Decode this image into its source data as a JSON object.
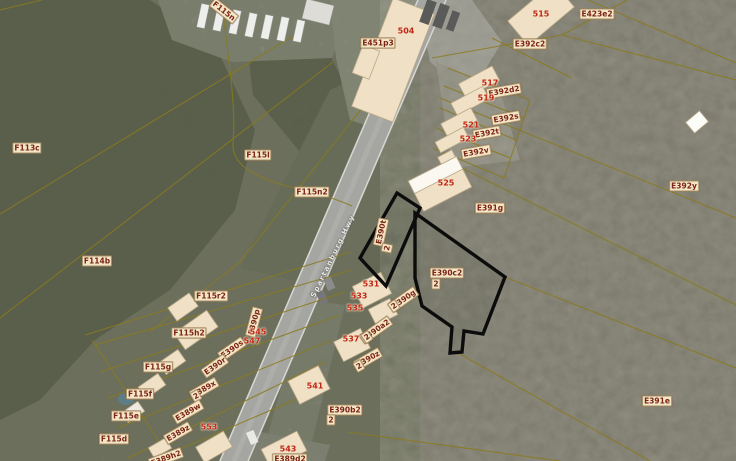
{
  "map": {
    "title": "aerial-parcel-map",
    "road_label": "Spartanburg Hwy",
    "selected_parcel": {
      "id": "E390c2",
      "sub": "2"
    },
    "colors": {
      "highlight_outline": "#0c0c0c",
      "parcel_line": "#8a7a1e",
      "parcel_label_text": "#7c2315",
      "parcel_label_bg": "#f2e6c6",
      "house_number_text": "#c22517",
      "building_fill": "#efe0c6",
      "woods": "#51554a",
      "field": "#79766a",
      "road": "#a5a5a1"
    },
    "parcel_labels": [
      {
        "text": "F115n",
        "x": 224,
        "y": 11,
        "rot": 38
      },
      {
        "text": "E451p3",
        "x": 378,
        "y": 43,
        "rot": 0
      },
      {
        "text": "E423e2",
        "x": 597,
        "y": 14,
        "rot": 0
      },
      {
        "text": "E392c2",
        "x": 530,
        "y": 44,
        "rot": 0
      },
      {
        "text": "E392d2",
        "x": 504,
        "y": 91,
        "rot": -10
      },
      {
        "text": "E392s",
        "x": 506,
        "y": 118,
        "rot": -10
      },
      {
        "text": "E392t",
        "x": 487,
        "y": 133,
        "rot": -10
      },
      {
        "text": "E392v",
        "x": 476,
        "y": 152,
        "rot": -10
      },
      {
        "text": "E392y",
        "x": 684,
        "y": 186,
        "rot": 0
      },
      {
        "text": "E391g",
        "x": 490,
        "y": 208,
        "rot": 0
      },
      {
        "text": "E391e",
        "x": 657,
        "y": 401,
        "rot": 0
      },
      {
        "text": "E390c2",
        "x": 447,
        "y": 273,
        "rot": 0
      },
      {
        "text": "2",
        "x": 436,
        "y": 284,
        "rot": 0
      },
      {
        "text": "E390t",
        "x": 381,
        "y": 232,
        "rot": -78
      },
      {
        "text": "2",
        "x": 387,
        "y": 248,
        "rot": -78
      },
      {
        "text": "E390g",
        "x": 404,
        "y": 299,
        "rot": -35
      },
      {
        "text": "2",
        "x": 394,
        "y": 306,
        "rot": -35
      },
      {
        "text": "E390a2",
        "x": 376,
        "y": 330,
        "rot": -35
      },
      {
        "text": "2",
        "x": 367,
        "y": 337,
        "rot": -35
      },
      {
        "text": "E390z",
        "x": 368,
        "y": 359,
        "rot": -30
      },
      {
        "text": "2",
        "x": 359,
        "y": 366,
        "rot": -30
      },
      {
        "text": "E390b2",
        "x": 345,
        "y": 410,
        "rot": 0
      },
      {
        "text": "2",
        "x": 331,
        "y": 420,
        "rot": 0
      },
      {
        "text": "E389d2",
        "x": 290,
        "y": 459,
        "rot": 0
      },
      {
        "text": "E390p",
        "x": 254,
        "y": 322,
        "rot": -75
      },
      {
        "text": "E390s",
        "x": 232,
        "y": 349,
        "rot": -35
      },
      {
        "text": "E390r",
        "x": 215,
        "y": 366,
        "rot": -35
      },
      {
        "text": "E389x",
        "x": 204,
        "y": 389,
        "rot": -30
      },
      {
        "text": "2",
        "x": 196,
        "y": 396,
        "rot": -30
      },
      {
        "text": "E389w",
        "x": 188,
        "y": 412,
        "rot": -30
      },
      {
        "text": "E389z",
        "x": 178,
        "y": 433,
        "rot": -30
      },
      {
        "text": "E389h2",
        "x": 166,
        "y": 458,
        "rot": -20
      },
      {
        "text": "F113c",
        "x": 27,
        "y": 148,
        "rot": 0
      },
      {
        "text": "F115l",
        "x": 258,
        "y": 155,
        "rot": 0
      },
      {
        "text": "F115n2",
        "x": 312,
        "y": 192,
        "rot": 0
      },
      {
        "text": "F114b",
        "x": 97,
        "y": 261,
        "rot": 0
      },
      {
        "text": "F115r2",
        "x": 211,
        "y": 296,
        "rot": 0
      },
      {
        "text": "F115h2",
        "x": 189,
        "y": 333,
        "rot": 0
      },
      {
        "text": "F115g",
        "x": 158,
        "y": 367,
        "rot": 0
      },
      {
        "text": "F115f",
        "x": 140,
        "y": 394,
        "rot": 0
      },
      {
        "text": "F115e",
        "x": 126,
        "y": 416,
        "rot": 0
      },
      {
        "text": "F115d",
        "x": 114,
        "y": 439,
        "rot": 0
      }
    ],
    "house_numbers": [
      {
        "text": "504",
        "x": 406,
        "y": 31
      },
      {
        "text": "515",
        "x": 541,
        "y": 14
      },
      {
        "text": "517",
        "x": 490,
        "y": 83
      },
      {
        "text": "519",
        "x": 486,
        "y": 98
      },
      {
        "text": "521",
        "x": 471,
        "y": 125
      },
      {
        "text": "523",
        "x": 468,
        "y": 139
      },
      {
        "text": "525",
        "x": 446,
        "y": 183
      },
      {
        "text": "531",
        "x": 371,
        "y": 284
      },
      {
        "text": "533",
        "x": 359,
        "y": 296
      },
      {
        "text": "535",
        "x": 355,
        "y": 308
      },
      {
        "text": "537",
        "x": 351,
        "y": 339
      },
      {
        "text": "541",
        "x": 315,
        "y": 386
      },
      {
        "text": "543",
        "x": 288,
        "y": 449
      },
      {
        "text": "545",
        "x": 258,
        "y": 332
      },
      {
        "text": "547",
        "x": 252,
        "y": 341
      },
      {
        "text": "553",
        "x": 209,
        "y": 427
      }
    ]
  }
}
